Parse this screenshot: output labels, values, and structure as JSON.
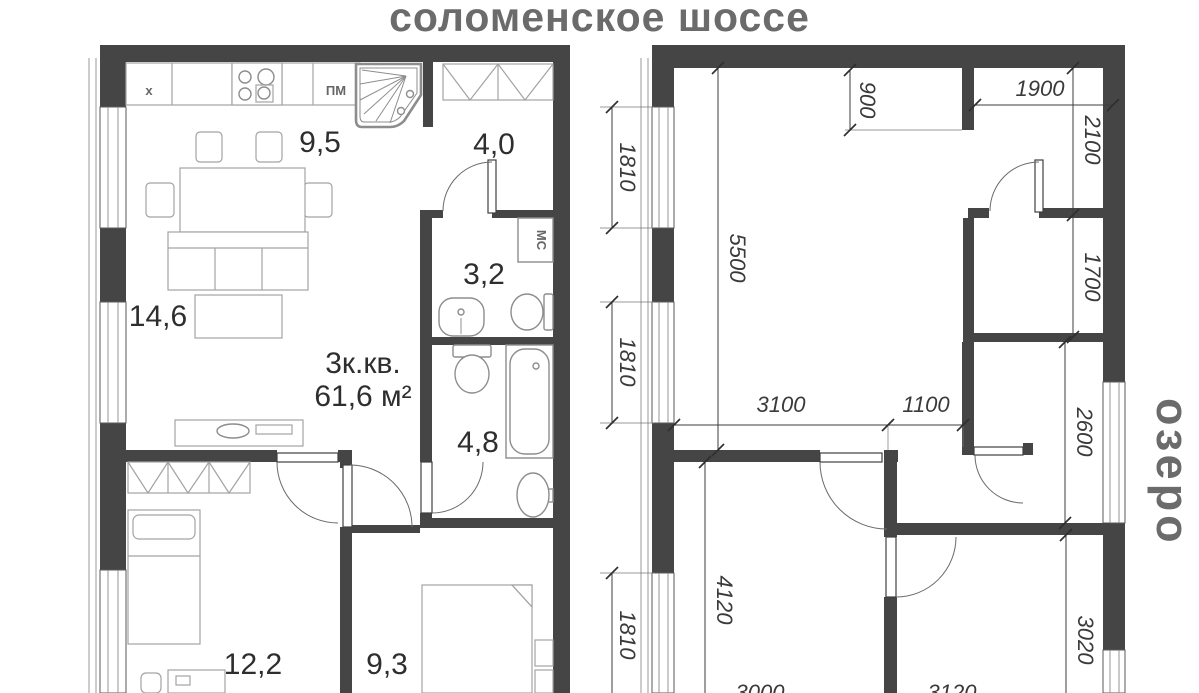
{
  "header": {
    "street_label": "соломенское шоссе"
  },
  "side_label": {
    "lake": "озеро"
  },
  "apartment": {
    "type": "3к.кв.",
    "area": "61,6 м²"
  },
  "room_areas": {
    "kitchen": "9,5",
    "hallway": "4,0",
    "wc_small": "3,2",
    "living": "14,6",
    "wc_large": "4,8",
    "bedroom_left": "12,2",
    "bedroom_right": "9,3"
  },
  "appliance_labels": {
    "hood": "х",
    "dishwasher": "ПМ",
    "washer": "МС"
  },
  "dimensions_mm": {
    "window_top": "1810",
    "window_mid": "1810",
    "window_bottom": "1810",
    "room_depth": "5500",
    "partition": "900",
    "closet_width": "1900",
    "closet_depth": "2100",
    "wc_depth": "1700",
    "bath_depth": "2600",
    "room_right_depth": "3020",
    "room_left_depth": "4120",
    "opening_left": "3100",
    "opening_right": "1100",
    "room_left_width": "3000",
    "room_right_width": "3120"
  },
  "colors": {
    "wall": "#454545",
    "furniture": "#a3a3a3",
    "text_dark": "#2e2e2e",
    "muted": "#6b6b6b"
  }
}
